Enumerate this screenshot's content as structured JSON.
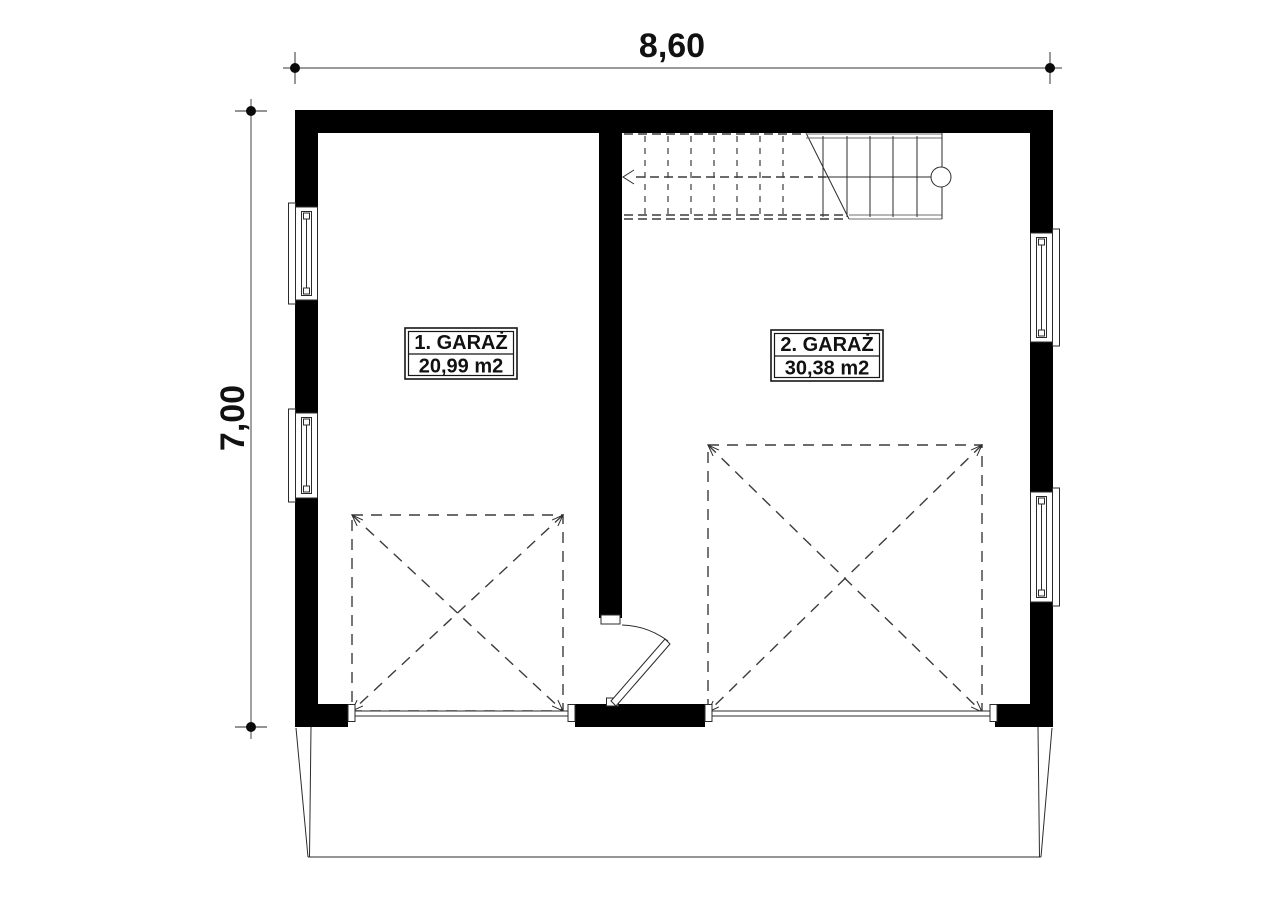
{
  "plan": {
    "type": "floor-plan",
    "dimensions": {
      "horizontal": "8,60",
      "vertical": "7,00"
    },
    "rooms": [
      {
        "label": "1. GARAŻ",
        "area": "20,99 m2"
      },
      {
        "label": "2. GARAŻ",
        "area": "30,38 m2"
      }
    ],
    "features": [
      "staircase-top-right",
      "two-windows-left-wall",
      "two-windows-right-wall",
      "two-garage-door-openings-bottom",
      "interior-swing-door-between-garages",
      "dashed-parking-spaces-with-x",
      "driveway-apron-below"
    ],
    "colors": {
      "wall": "#000000",
      "background": "#ffffff",
      "thin_line": "#2b2b2b",
      "dashed_line": "#3c3c3c",
      "dimension_line": "#7a7a7a",
      "text": "#111111"
    }
  }
}
